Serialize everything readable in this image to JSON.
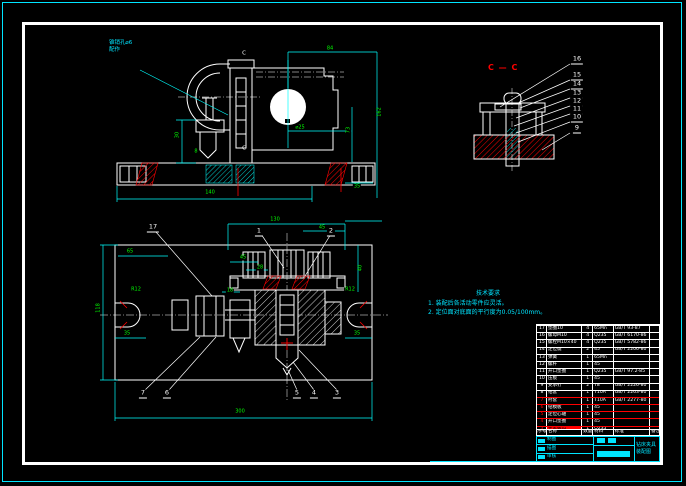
{
  "drawing": {
    "leader_note": {
      "line1": "锥销孔⌀6",
      "line2": "配作"
    },
    "section_label": "C — C",
    "section_mark": "C",
    "notes": {
      "title": "技术要求",
      "items": [
        "1. 装配后各活动零件应灵活。",
        "2. 定位面对底面的平行度为0.05/100mm。"
      ]
    },
    "front_dims": {
      "top": "84",
      "right": "73",
      "overall": "162",
      "bottom": "140",
      "col": "30",
      "hole": "⌀25",
      "small8": "8",
      "small35": "35"
    },
    "plan_dims": {
      "top": "130",
      "topright": "45",
      "right": "40",
      "bottom": "300",
      "left": "118",
      "l65": "65",
      "l35": "35",
      "r35": "35",
      "c45": "45",
      "c28": "28",
      "c18": "18",
      "rl": "R12",
      "rr": "R12"
    },
    "plan_callouts": {
      "c17": "17",
      "c1": "1",
      "c2": "2",
      "c3": "3",
      "c4": "4",
      "c5": "5",
      "c6": "6",
      "c7": "7"
    },
    "section_balloons": [
      "16",
      "15",
      "14",
      "13",
      "12",
      "11",
      "10",
      "9"
    ]
  },
  "bom": {
    "headers": [
      "序号",
      "名称",
      "数量",
      "材料",
      "标准",
      "备注"
    ],
    "rows": [
      {
        "no": "17",
        "name": "垫圈10",
        "qty": "4",
        "mat": "65Mn",
        "std": "GB/T 93-87"
      },
      {
        "no": "16",
        "name": "螺母M10",
        "qty": "4",
        "mat": "Q235",
        "std": "GB/T 6170-86"
      },
      {
        "no": "15",
        "name": "螺栓M10×40",
        "qty": "4",
        "mat": "Q235",
        "std": "GB/T 5782-86"
      },
      {
        "no": "14",
        "name": "定位键",
        "qty": "2",
        "mat": "45",
        "std": "GB/T 2206-80"
      },
      {
        "no": "13",
        "name": "弹簧",
        "qty": "1",
        "mat": "65Mn",
        "std": ""
      },
      {
        "no": "12",
        "name": "螺杆",
        "qty": "1",
        "mat": "45",
        "std": ""
      },
      {
        "no": "11",
        "name": "开口垫圈",
        "qty": "1",
        "mat": "Q235",
        "std": "GB/T 97.2-85"
      },
      {
        "no": "10",
        "name": "压板",
        "qty": "1",
        "mat": "45",
        "std": ""
      },
      {
        "no": "9",
        "name": "支承钉",
        "qty": "2",
        "mat": "T8",
        "std": "GB/T 2226-80"
      },
      {
        "no": "8",
        "name": "钻套",
        "qty": "1",
        "mat": "T10A",
        "std": "GB/T 2263-80"
      },
      {
        "no": "7",
        "name": "衬套",
        "qty": "1",
        "mat": "T10A",
        "std": "GB/T 2277-80",
        "cls": "red"
      },
      {
        "no": "6",
        "name": "钻模板",
        "qty": "1",
        "mat": "45",
        "std": "",
        "cls": "red"
      },
      {
        "no": "5",
        "name": "定位心轴",
        "qty": "1",
        "mat": "45",
        "std": "",
        "cls": "red"
      },
      {
        "no": "4",
        "name": "开口垫圈",
        "qty": "1",
        "mat": "45",
        "std": "",
        "cls": "red"
      },
      {
        "no": "3",
        "name": "夹紧螺母",
        "qty": "1",
        "mat": "Q235",
        "std": "",
        "cls": "red hl"
      },
      {
        "no": "2",
        "name": "定位销",
        "qty": "1",
        "mat": "T8",
        "std": "GB/T 2203-80",
        "cls": "red"
      },
      {
        "no": "1",
        "name": "夹具体",
        "qty": "1",
        "mat": "HT200",
        "std": "",
        "cls": "red"
      }
    ]
  },
  "titleblock": {
    "fields": [
      "制图",
      "描图",
      "审核"
    ],
    "line1": "钻床夹具",
    "line2": "装配图"
  },
  "colors": {
    "line": "#ffffff",
    "dimension": "#00e5ff",
    "dim_text": "#00ff00",
    "hatch": "#ff0000",
    "background": "#000000"
  }
}
